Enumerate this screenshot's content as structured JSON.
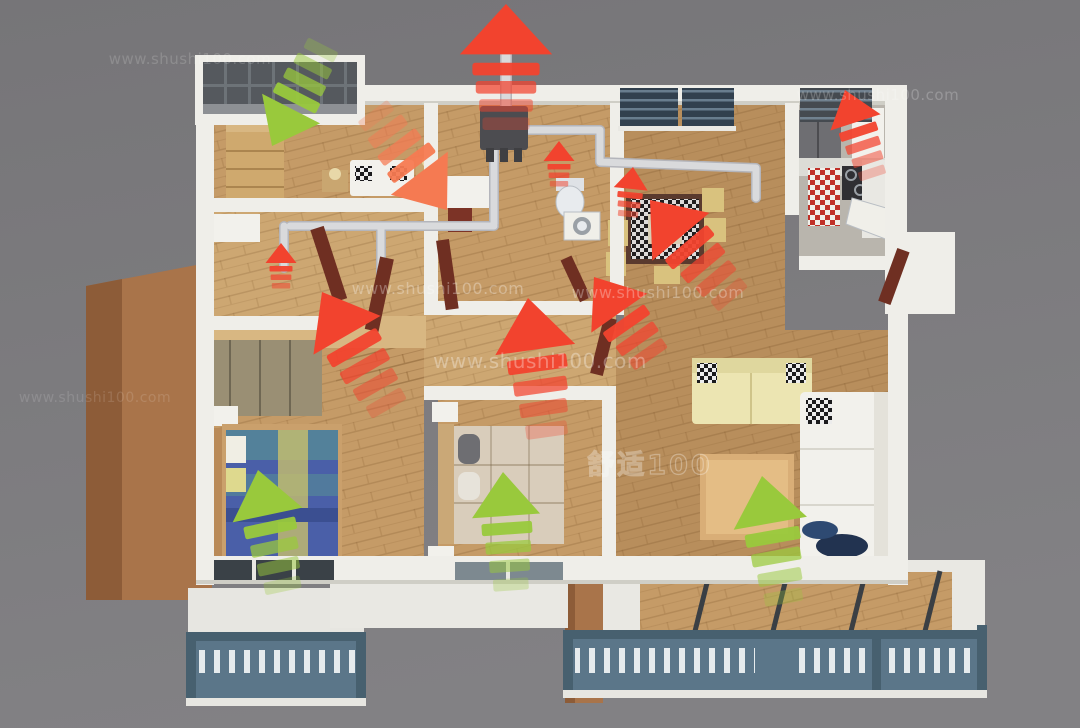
{
  "image": {
    "width": 1080,
    "height": 728
  },
  "palette": {
    "background": "#7b7a7c",
    "background_light": "#858487",
    "wall": "#efeee9",
    "wall_shadow": "#cfcec6",
    "floor_wood": "#c59b67",
    "floor_wood_dark": "#b88e5c",
    "floor_wood_light": "#cda772",
    "floor_gray": "#b9b5ad",
    "facade_brown": "#a9744a",
    "facade_brown_dark": "#8d5c38",
    "railing": "#5b7689",
    "railing_dark": "#47606f",
    "glazing": "#55595e",
    "glazing_mullion": "#6d7378",
    "duct": "#d9dadc",
    "duct_edge": "#b4b5bb",
    "hrv_unit": "#4c4c50",
    "mahogany": "#6f2f22",
    "light_wood": "#d8b782",
    "cream": "#ece5b2",
    "white_fabric": "#f2f1ec",
    "bed_blue": "#4a5fa8",
    "bed_teal": "#53819a",
    "bed_yellow": "#cfc469",
    "beige_bed": "#d9cdbb",
    "red_cabinet": "#c03028",
    "exhaust_red": "#f2432e",
    "exhaust_salmon": "#f57a52",
    "fresh_green": "#99c93c"
  },
  "watermarks": [
    {
      "text": "www.shushi100.com",
      "x": 190,
      "y": 64,
      "size": 15,
      "opacity": 0.16
    },
    {
      "text": "www.shushi100.com",
      "x": 878,
      "y": 100,
      "size": 15,
      "opacity": 0.22
    },
    {
      "text": "www.shushi100.com",
      "x": 438,
      "y": 294,
      "size": 16,
      "opacity": 0.3
    },
    {
      "text": "www.shushi100.com",
      "x": 658,
      "y": 298,
      "size": 16,
      "opacity": 0.3
    },
    {
      "text": "www.shushi100.com",
      "x": 540,
      "y": 368,
      "size": 20,
      "opacity": 0.32
    },
    {
      "text": "www.shushi100.com",
      "x": 95,
      "y": 402,
      "size": 14,
      "opacity": 0.13
    }
  ],
  "brand_watermark": {
    "text": "舒适100",
    "x": 650,
    "y": 474,
    "size": 27,
    "opacity": 0.3
  },
  "airflow": {
    "fresh_meaning": "fresh air intake",
    "exhaust_meaning": "exhaust air",
    "arrows": [
      {
        "name": "exhaust-roof-outlet",
        "type": "exhaust",
        "x": 506,
        "y": 4,
        "angle": 0,
        "scale": 1.4,
        "stripes": 4,
        "hw": 33,
        "hh": 36,
        "sw": 24,
        "sh": 9,
        "step": 13
      },
      {
        "name": "fresh-north-balcony",
        "type": "fresh",
        "x": 272,
        "y": 146,
        "angle": 207,
        "scale": 1.05,
        "stripes": 4
      },
      {
        "name": "exhaust-study",
        "type": "exhaust",
        "x": 447,
        "y": 210,
        "angle": 143,
        "scale": 1.15,
        "stripes": 4,
        "tint": "salmon"
      },
      {
        "name": "exhaust-entry-small",
        "type": "exhaust",
        "x": 281,
        "y": 243,
        "angle": 0,
        "scale": 0.5,
        "stripes": 3
      },
      {
        "name": "exhaust-hallway",
        "type": "exhaust",
        "x": 322,
        "y": 292,
        "angle": -30,
        "scale": 1.25,
        "stripes": 4
      },
      {
        "name": "exhaust-bathroom-small",
        "type": "exhaust",
        "x": 559,
        "y": 141,
        "angle": 0,
        "scale": 0.5,
        "stripes": 3
      },
      {
        "name": "exhaust-dining-small",
        "type": "exhaust",
        "x": 633,
        "y": 167,
        "angle": 6,
        "scale": 0.55,
        "stripes": 3
      },
      {
        "name": "exhaust-dining",
        "type": "exhaust",
        "x": 650,
        "y": 200,
        "angle": -40,
        "scale": 1.2,
        "stripes": 4
      },
      {
        "name": "exhaust-living-to-hall",
        "type": "exhaust",
        "x": 594,
        "y": 277,
        "angle": -35,
        "scale": 1.1,
        "stripes": 3
      },
      {
        "name": "exhaust-bedroom-2",
        "type": "exhaust",
        "x": 528,
        "y": 298,
        "angle": -8,
        "scale": 1.3,
        "stripes": 4
      },
      {
        "name": "exhaust-kitchen",
        "type": "exhaust",
        "x": 845,
        "y": 90,
        "angle": -18,
        "scale": 0.85,
        "stripes": 4
      },
      {
        "name": "fresh-master-bedroom",
        "type": "fresh",
        "x": 258,
        "y": 470,
        "angle": -12,
        "scale": 1.15,
        "stripes": 4
      },
      {
        "name": "fresh-bedroom-2",
        "type": "fresh",
        "x": 503,
        "y": 472,
        "angle": -4,
        "scale": 1.1,
        "stripes": 4
      },
      {
        "name": "fresh-living-room",
        "type": "fresh",
        "x": 762,
        "y": 476,
        "angle": -10,
        "scale": 1.2,
        "stripes": 4
      }
    ]
  }
}
